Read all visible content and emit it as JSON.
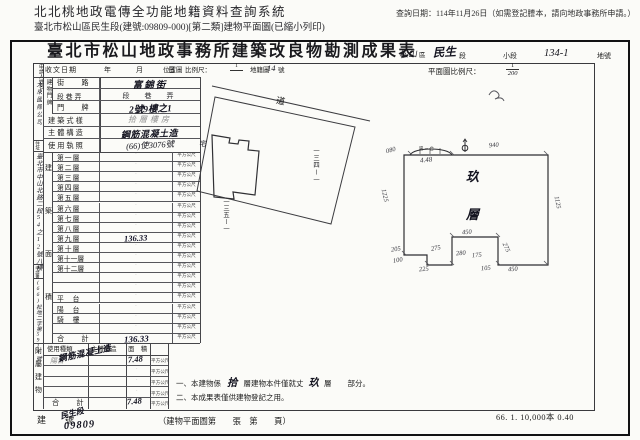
{
  "header": {
    "system_title": "北北桃地政電傳全功能地籍資料查詢系統",
    "query_date": "查詢日期：114年11月26日（如需登記謄本，請向地政事務所申請。）",
    "doc_info": "臺北市松山區民生段(建號:09809-000)[第二類]建物平面圖(已縮小列印)"
  },
  "form": {
    "title": "臺北市松山地政事務所建築改良物勘測成果表",
    "district": {
      "hw_city": "松山",
      "p_district": "區",
      "hw_section": "民生",
      "p_section": "段",
      "p_subsection": "小段",
      "hw_lot": "134-1",
      "p_lot": "地號"
    },
    "band": {
      "receive_label": "收文日期",
      "ymd": "年　月　日",
      "locmap": "位置圖",
      "scale_label": "比例尺：",
      "scale_num": "1",
      "cad_label": "地籍圖",
      "cad_no": "14",
      "cad_unit": "號",
      "plan_scale_label": "平面圖比例尺：",
      "plan_num": "1",
      "plan_den": "200"
    },
    "applicant": {
      "label_top": "申請人",
      "label_bottom": "姓名",
      "name": "大來國際公司",
      "addr_label": "住址",
      "address": "臺北市中山北路二段54之12號八樓",
      "doc_label": "申請書",
      "doc_no": "(66)松地二字第5914號"
    },
    "fields": {
      "premise_vlabel": "建物門牌",
      "street_label": "街　路",
      "street_value": "富錦街",
      "sec_label": "段巷弄",
      "sec_value": "段　巷　弄",
      "door_label": "門　牌",
      "door_value": "2號9樓之1",
      "style_label": "建築式樣",
      "style_value": "拾層樓房",
      "struct_label": "主體構造",
      "struct_value": "鋼筋混凝土造",
      "license_label": "使用執照",
      "license_value": "(66)使3076號"
    },
    "area_vlabel": "建築面積",
    "unit": "平方公尺",
    "floors": [
      {
        "label": "第一層",
        "value": "·"
      },
      {
        "label": "第二層",
        "value": "·"
      },
      {
        "label": "第三層",
        "value": "·"
      },
      {
        "label": "第四層",
        "value": "·"
      },
      {
        "label": "第五層",
        "value": "·"
      },
      {
        "label": "第六層",
        "value": "·"
      },
      {
        "label": "第七層",
        "value": "·"
      },
      {
        "label": "第八層",
        "value": "·"
      },
      {
        "label": "第九層",
        "value": "136.33"
      },
      {
        "label": "第十層",
        "value": "·"
      },
      {
        "label": "第十一層",
        "value": "·"
      },
      {
        "label": "第十二層",
        "value": "·"
      },
      {
        "label": "",
        "value": "·"
      },
      {
        "label": "",
        "value": "·"
      },
      {
        "label": "平　台",
        "value": "·"
      },
      {
        "label": "陽　台",
        "value": "·"
      },
      {
        "label": "騎　樓",
        "value": "·"
      },
      {
        "label": "",
        "value": "·"
      }
    ],
    "total_label": "合　計",
    "floors_total": "136.33",
    "annex": {
      "vlabel": "附屬建物",
      "h_kind": "使用種類",
      "h_struct": "主體構造",
      "h_area": "面　積",
      "kind": "陽台",
      "structure": "鋼筋混凝土造",
      "area": "7.48",
      "dot": "·",
      "total_label": "合　計",
      "total": "7.48"
    },
    "notes": {
      "l1a": "一、本建物係",
      "hw1": "拾",
      "l1b": "層建物本件僅就丈",
      "hw2": "玖",
      "l1c": "層",
      "l1d": "部分。",
      "l2": "二、本成果表僅供建物登記之用。"
    },
    "bottom": {
      "bno_label": "建　號",
      "hw_sec": "民生段",
      "hw_no": "09809",
      "page_note": "（建物平面圖第　　張　第　　頁）",
      "print_note": "66. 1. 10,000本 0.40"
    },
    "locmap": {
      "road": "道",
      "lot_right": "一三四ー一",
      "lot_bottom": "一三五ー一",
      "house": "宅"
    },
    "plan": {
      "f1": "玖",
      "f2": "層",
      "balcony": "陽－台",
      "bal_dim": "4.48",
      "d_tl": "080",
      "d_top": "940",
      "d_left": "1225",
      "d_right": "1125",
      "d_notch": "450",
      "d1": "205",
      "d2": "275",
      "d3": "280",
      "d4": "175",
      "d5": "275",
      "d6": "100",
      "d7": "225",
      "d8": "105",
      "d9": "450"
    }
  }
}
